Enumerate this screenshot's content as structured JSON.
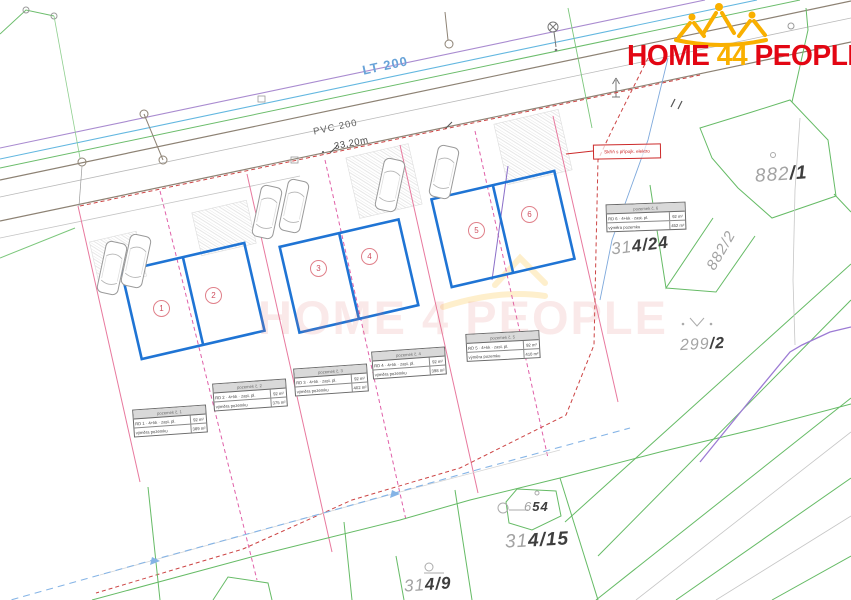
{
  "logo": {
    "home": "HOME",
    "four": "4",
    "people": "PEOPLE"
  },
  "watermark": "HOME 4 PEOPLE",
  "road": {
    "lt_label": "LT 200",
    "pvc_label": "PVC 200",
    "dim_label": "33,20m"
  },
  "connection_label": "Skříň s přípojk. elektro",
  "houses": [
    {
      "no": "1"
    },
    {
      "no": "2"
    },
    {
      "no": "3"
    },
    {
      "no": "4"
    },
    {
      "no": "5"
    },
    {
      "no": "6"
    }
  ],
  "parcels": [
    {
      "id": "882/1",
      "light": "882",
      "dark": "/1"
    },
    {
      "id": "882/2",
      "light": "882/2",
      "dark": ""
    },
    {
      "id": "314/24",
      "light": "31",
      "dark": "4/24"
    },
    {
      "id": "299/2",
      "light": "299",
      "dark": "/2"
    },
    {
      "id": "654",
      "light": "6",
      "dark": "54"
    },
    {
      "id": "314/15",
      "light": "31",
      "dark": "4/15"
    },
    {
      "id": "314/9",
      "light": "31",
      "dark": "4/9"
    }
  ],
  "tables": [
    {
      "header": "pozemek č. 1",
      "r1c1": "RD 1 · 4+kk · zast. pl.",
      "r1c2": "92 m²",
      "r2c1": "výměra pozemku",
      "r2c2": "389 m²"
    },
    {
      "header": "pozemek č. 2",
      "r1c1": "RD 2 · 4+kk · zast. pl.",
      "r1c2": "92 m²",
      "r2c1": "výměra pozemku",
      "r2c2": "375 m²"
    },
    {
      "header": "pozemek č. 3",
      "r1c1": "RD 3 · 4+kk · zast. pl.",
      "r1c2": "92 m²",
      "r2c1": "výměra pozemku",
      "r2c2": "402 m²"
    },
    {
      "header": "pozemek č. 4",
      "r1c1": "RD 4 · 4+kk · zast. pl.",
      "r1c2": "92 m²",
      "r2c1": "výměra pozemku",
      "r2c2": "398 m²"
    },
    {
      "header": "pozemek č. 5",
      "r1c1": "RD 5 · 4+kk · zast. pl.",
      "r1c2": "92 m²",
      "r2c1": "výměra pozemku",
      "r2c2": "410 m²"
    },
    {
      "header": "pozemek č. 6",
      "r1c1": "RD 6 · 4+kk · zast. pl.",
      "r1c2": "92 m²",
      "r2c1": "výměra pozemku",
      "r2c2": "452 m²"
    }
  ]
}
